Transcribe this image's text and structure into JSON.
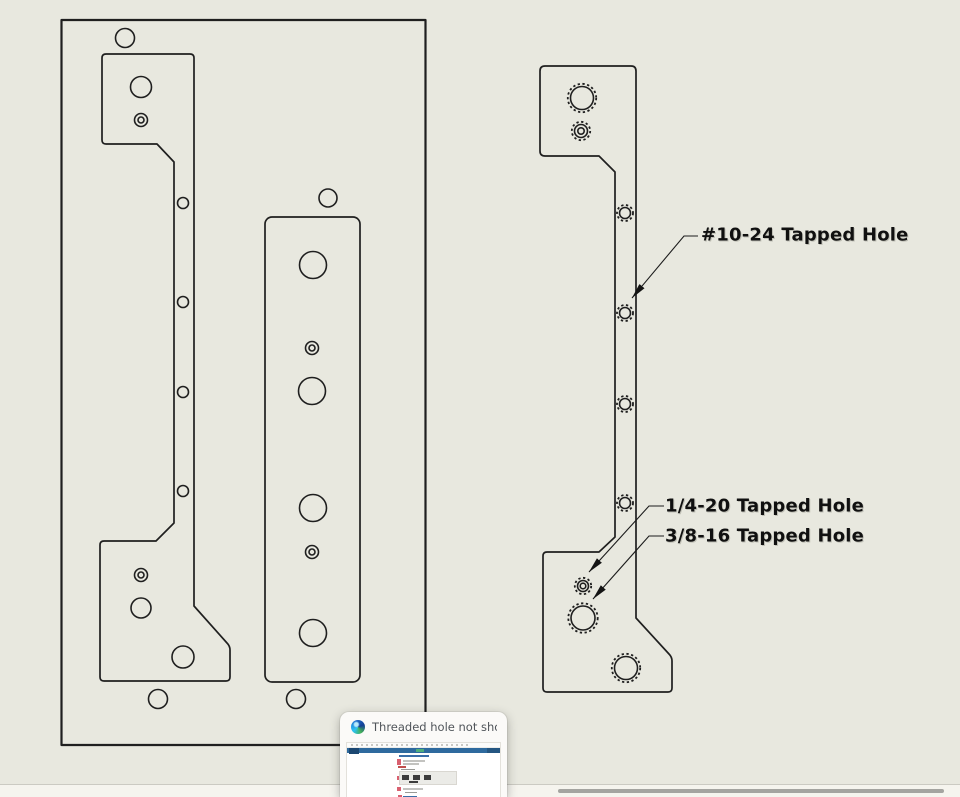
{
  "app": {
    "background_color": "#e8e8df",
    "line_color": "#1f1f1f",
    "note_text_color": "#101010"
  },
  "annotations": [
    {
      "label": "#10-24 Tapped Hole"
    },
    {
      "label": "1/4-20 Tapped Hole"
    },
    {
      "label": "3/8-16 Tapped Hole"
    }
  ],
  "taskbar_preview": {
    "icon": "edge-browser-icon",
    "title": "Threaded hole not showin..."
  }
}
